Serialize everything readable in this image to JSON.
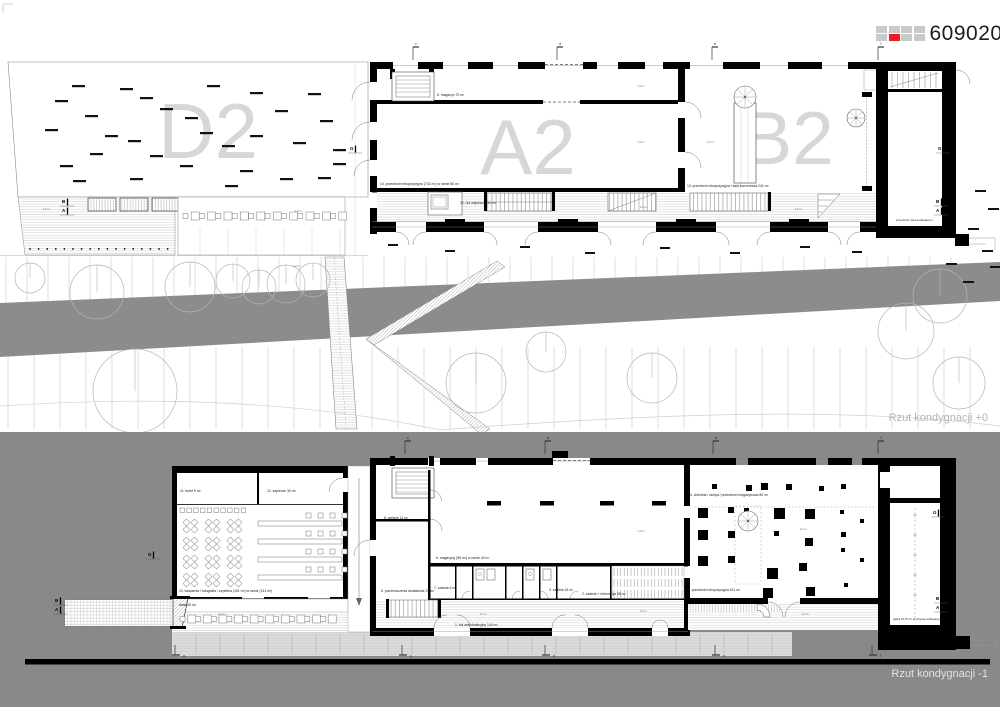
{
  "header": {
    "code": "609020",
    "grid": {
      "rows": 2,
      "cols": 4,
      "red_cell": [
        1,
        1
      ],
      "gray": "#c9c9c9",
      "red": "#ec1c24"
    }
  },
  "captions": {
    "upper": "Rzut kondygnacji +0",
    "lower": "Rzut kondygnacji -1"
  },
  "colors": {
    "page_bg": "#ffffff",
    "wall": "#000000",
    "zone_letter": "#d7d7d7",
    "road_gray": "#8c8c8c",
    "lower_bg": "#898989",
    "caption_upper": "#b3b3b3",
    "caption_lower": "#e3e3e3",
    "accent_red": "#ec1c24",
    "square_gray": "#c9c9c9",
    "tree": "#b5b5b5"
  },
  "zone_labels": [
    {
      "text": "D2",
      "x": 208,
      "y": 131,
      "size": 78
    },
    {
      "text": "A2",
      "x": 528,
      "y": 147,
      "size": 78
    },
    {
      "text": "B2",
      "x": 788,
      "y": 138,
      "size": 75
    },
    {
      "text": "D1",
      "x": 284,
      "y": 547,
      "size": 78
    },
    {
      "text": "A1",
      "x": 528,
      "y": 523,
      "size": 78
    },
    {
      "text": "B1",
      "x": 777,
      "y": 546,
      "size": 75
    }
  ],
  "room_labels": [
    {
      "t": "5. magazyn 70 m²",
      "x": 437,
      "y": 96
    },
    {
      "t": "14. przestrzeń ekspozycyjna (731 m²) w ramie 80 m²",
      "x": 380,
      "y": 185
    },
    {
      "t": "12. hol wejściowy 94 m²",
      "x": 460,
      "y": 204
    },
    {
      "t": "13. przestrzeń ekspozycyjna / sala koncertowa 241 m²",
      "x": 687,
      "y": 187
    },
    {
      "t": "przestrzeń pod amfiteatrem",
      "x": 896,
      "y": 221,
      "s": 3
    },
    {
      "t": "11. bufet 9 m²",
      "x": 180,
      "y": 492
    },
    {
      "t": "12. zaplecze 30 m²",
      "x": 267,
      "y": 492
    },
    {
      "t": "10. kawiarnia / fotografia / czytelnia (151 m²) w ramie (141 m²)",
      "x": 179,
      "y": 592
    },
    {
      "t": "taras 60 m²",
      "x": 179,
      "y": 606
    },
    {
      "t": "8. wejście 11 m²",
      "x": 384,
      "y": 519
    },
    {
      "t": "5. pomieszczenia dodatkowe 23 m²",
      "x": 381,
      "y": 592
    },
    {
      "t": "6. magazyny (55 m²) w ramie 42 m²",
      "x": 436,
      "y": 559
    },
    {
      "t": "7. szatnia 9 m²",
      "x": 434,
      "y": 589
    },
    {
      "t": "3. szatnia 15 m²",
      "x": 549,
      "y": 591
    },
    {
      "t": "2. szatnia + informacja 36 m²",
      "x": 582,
      "y": 595
    },
    {
      "t": "1. hol wielofunkcyjny 144 m²",
      "x": 455,
      "y": 626
    },
    {
      "t": "3. chłodnia / rampa / przestrzeń magazynowa 80 m²",
      "x": 690,
      "y": 496
    },
    {
      "t": "4. przestrzeń ekspozycyjna 511 m²",
      "x": 688,
      "y": 591
    },
    {
      "t": "wjazd 23,75 m² (pochylnia amfiteatru)",
      "x": 893,
      "y": 620,
      "s": 2.8
    },
    {
      "t": "1,2 m",
      "x": 638,
      "y": 87,
      "s": 2.6,
      "c": "#555555"
    },
    {
      "t": "1,2 m",
      "x": 638,
      "y": 143,
      "s": 2.6,
      "c": "#555555"
    },
    {
      "t": "1,2 m",
      "x": 707,
      "y": 143,
      "s": 2.6,
      "c": "#555555"
    },
    {
      "t": "1,2 m",
      "x": 640,
      "y": 208,
      "s": 2.6,
      "c": "#555555"
    },
    {
      "t": "1,2 m",
      "x": 795,
      "y": 210,
      "s": 2.6,
      "c": "#555555"
    },
    {
      "t": "1,2 m",
      "x": 43,
      "y": 210,
      "s": 2.6,
      "c": "#555555"
    },
    {
      "t": "1,2 m",
      "x": 295,
      "y": 212,
      "s": 2.6,
      "c": "#555555"
    },
    {
      "t": "1,2 m",
      "x": 293,
      "y": 267,
      "s": 2.6,
      "c": "#555555"
    },
    {
      "t": "1,2 m",
      "x": 638,
      "y": 532,
      "s": 2.6,
      "c": "#555555"
    },
    {
      "t": "1,2 m",
      "x": 640,
      "y": 612,
      "s": 2.6,
      "c": "#555555"
    },
    {
      "t": "1,2 m",
      "x": 218,
      "y": 615,
      "s": 2.6,
      "c": "#555555"
    },
    {
      "t": "1,2 m",
      "x": 800,
      "y": 530,
      "s": 2.6,
      "c": "#555555"
    },
    {
      "t": "1,2 m",
      "x": 802,
      "y": 615,
      "s": 2.6,
      "c": "#555555"
    },
    {
      "t": "1,2 m",
      "x": 480,
      "y": 615,
      "s": 2.6,
      "c": "#555555"
    }
  ],
  "axis_flags": {
    "upper_top": {
      "y": 47,
      "items": [
        {
          "x": 413,
          "l": "c"
        },
        {
          "x": 557,
          "l": "d"
        },
        {
          "x": 712,
          "l": "e"
        },
        {
          "x": 878,
          "l": "f"
        }
      ]
    },
    "lower_top": {
      "y": 441,
      "items": [
        {
          "x": 405,
          "l": "c"
        },
        {
          "x": 545,
          "l": "d"
        },
        {
          "x": 713,
          "l": "e"
        },
        {
          "x": 878,
          "l": "f"
        }
      ]
    },
    "lower_bottom": {
      "y": 645,
      "items": [
        {
          "x": 175,
          "l": "a"
        },
        {
          "x": 402,
          "l": "c"
        },
        {
          "x": 545,
          "l": "d"
        },
        {
          "x": 715,
          "l": "e"
        },
        {
          "x": 872,
          "l": "f"
        }
      ]
    }
  },
  "section_markers": [
    {
      "x": 350,
      "y": 150,
      "labels": [
        "G"
      ]
    },
    {
      "x": 938,
      "y": 150,
      "labels": [
        "G"
      ]
    },
    {
      "x": 62,
      "y": 203,
      "labels": [
        "B",
        "A"
      ]
    },
    {
      "x": 936,
      "y": 203,
      "labels": [
        "B",
        "A"
      ]
    },
    {
      "x": 148,
      "y": 556,
      "labels": [
        "G"
      ]
    },
    {
      "x": 933,
      "y": 514,
      "labels": [
        "G"
      ]
    },
    {
      "x": 55,
      "y": 602,
      "labels": [
        "B",
        "A"
      ]
    },
    {
      "x": 936,
      "y": 600,
      "labels": [
        "B",
        "A"
      ]
    }
  ],
  "d2_dashes": [
    [
      72,
      85
    ],
    [
      120,
      88
    ],
    [
      160,
      108
    ],
    [
      207,
      85
    ],
    [
      250,
      92
    ],
    [
      308,
      93
    ],
    [
      55,
      100
    ],
    [
      140,
      97
    ],
    [
      185,
      117
    ],
    [
      275,
      110
    ],
    [
      320,
      120
    ],
    [
      85,
      115
    ],
    [
      105,
      135
    ],
    [
      45,
      129
    ],
    [
      128,
      140
    ],
    [
      200,
      132
    ],
    [
      250,
      135
    ],
    [
      293,
      142
    ],
    [
      333,
      149
    ],
    [
      90,
      153
    ],
    [
      150,
      155
    ],
    [
      222,
      145
    ],
    [
      180,
      165
    ],
    [
      240,
      170
    ],
    [
      60,
      165
    ],
    [
      130,
      178
    ],
    [
      280,
      178
    ],
    [
      318,
      177
    ],
    [
      73,
      180
    ],
    [
      225,
      185
    ],
    [
      333,
      163
    ]
  ],
  "edge_dashes": [
    [
      975,
      190
    ],
    [
      988,
      208
    ],
    [
      968,
      228
    ],
    [
      982,
      250
    ],
    [
      990,
      266
    ],
    [
      963,
      281
    ],
    [
      946,
      263
    ]
  ],
  "apron_dashes": [
    [
      388,
      244
    ],
    [
      445,
      250
    ],
    [
      520,
      246
    ],
    [
      585,
      252
    ],
    [
      660,
      247
    ],
    [
      730,
      252
    ],
    [
      800,
      246
    ],
    [
      852,
      251
    ]
  ],
  "trees": [
    [
      30,
      278,
      15
    ],
    [
      97,
      292,
      27
    ],
    [
      190,
      287,
      25
    ],
    [
      233,
      281,
      17
    ],
    [
      259,
      287,
      17
    ],
    [
      286,
      284,
      19
    ],
    [
      313,
      280,
      17
    ],
    [
      940,
      296,
      27
    ],
    [
      135,
      391,
      42
    ],
    [
      476,
      383,
      30
    ],
    [
      546,
      352,
      20
    ],
    [
      652,
      378,
      25
    ],
    [
      906,
      331,
      28
    ],
    [
      959,
      383,
      26
    ]
  ],
  "b1_columns": [
    [
      712,
      484,
      5
    ],
    [
      746,
      485,
      6
    ],
    [
      761,
      483,
      7
    ],
    [
      786,
      484,
      6
    ],
    [
      819,
      486,
      5
    ],
    [
      841,
      484,
      5
    ],
    [
      698,
      508,
      10
    ],
    [
      728,
      507,
      6
    ],
    [
      744,
      508,
      5
    ],
    [
      774,
      508,
      11
    ],
    [
      805,
      509,
      10
    ],
    [
      840,
      510,
      4
    ],
    [
      698,
      530,
      10
    ],
    [
      728,
      531,
      7
    ],
    [
      774,
      531,
      5
    ],
    [
      805,
      538,
      8
    ],
    [
      841,
      532,
      5
    ],
    [
      698,
      556,
      10
    ],
    [
      728,
      556,
      7
    ],
    [
      767,
      568,
      11
    ],
    [
      799,
      563,
      8
    ],
    [
      841,
      548,
      4
    ],
    [
      763,
      588,
      10
    ],
    [
      806,
      587,
      9
    ],
    [
      844,
      583,
      4
    ],
    [
      860,
      519,
      4
    ],
    [
      860,
      558,
      4
    ]
  ],
  "spirals": [
    [
      745,
      97,
      11
    ],
    [
      856,
      118,
      9
    ],
    [
      748,
      521,
      10
    ]
  ],
  "d1": {
    "cluster_cols": [
      184,
      206,
      228
    ],
    "cluster_rows": [
      520,
      538,
      556,
      574
    ],
    "chair_row": {
      "x": 180,
      "y": 508,
      "n": 10,
      "step": 6.8
    },
    "tables": {
      "x": 258,
      "w": 84,
      "rows": [
        521,
        539,
        557,
        575
      ],
      "chair_xs": [
        306,
        318,
        330,
        342
      ]
    }
  },
  "terrace_diamonds": [
    [
      40,
      214
    ],
    [
      72,
      209
    ],
    [
      106,
      220
    ],
    [
      138,
      211
    ],
    [
      58,
      233
    ],
    [
      92,
      238
    ],
    [
      126,
      236
    ],
    [
      152,
      224
    ]
  ],
  "terrace_rows": {
    "upper": {
      "x": 183,
      "y": 212,
      "n": 20,
      "step": 8.2
    },
    "lower": {
      "x": 180,
      "y": 615,
      "n": 20,
      "step": 7.8
    }
  },
  "dots_row": {
    "x": 30,
    "y": 249,
    "n": 17,
    "step": 8.6
  },
  "tick_configs": [
    {
      "gid": "site-lines",
      "x0": 6,
      "x1": 962,
      "step": 21,
      "y1": 257,
      "y2": 303,
      "c": "#c9c9c9",
      "w": 0.6
    },
    {
      "gid": "site-lines",
      "x0": 8,
      "x1": 994,
      "step": 26,
      "y1": 347,
      "y2": 429,
      "c": "#c9c9c9",
      "w": 0.6
    },
    {
      "gid": "band-ticks",
      "x0": 196,
      "x1": 772,
      "step": 24,
      "y1": 634,
      "y2": 654,
      "c": "#a8a8a8",
      "w": 0.5
    }
  ],
  "a1_tick_zone": {
    "x0": 614,
    "x1": 682,
    "step": 3.4,
    "rows": [
      568,
      579,
      590
    ],
    "h": 8,
    "c": "#888888"
  }
}
